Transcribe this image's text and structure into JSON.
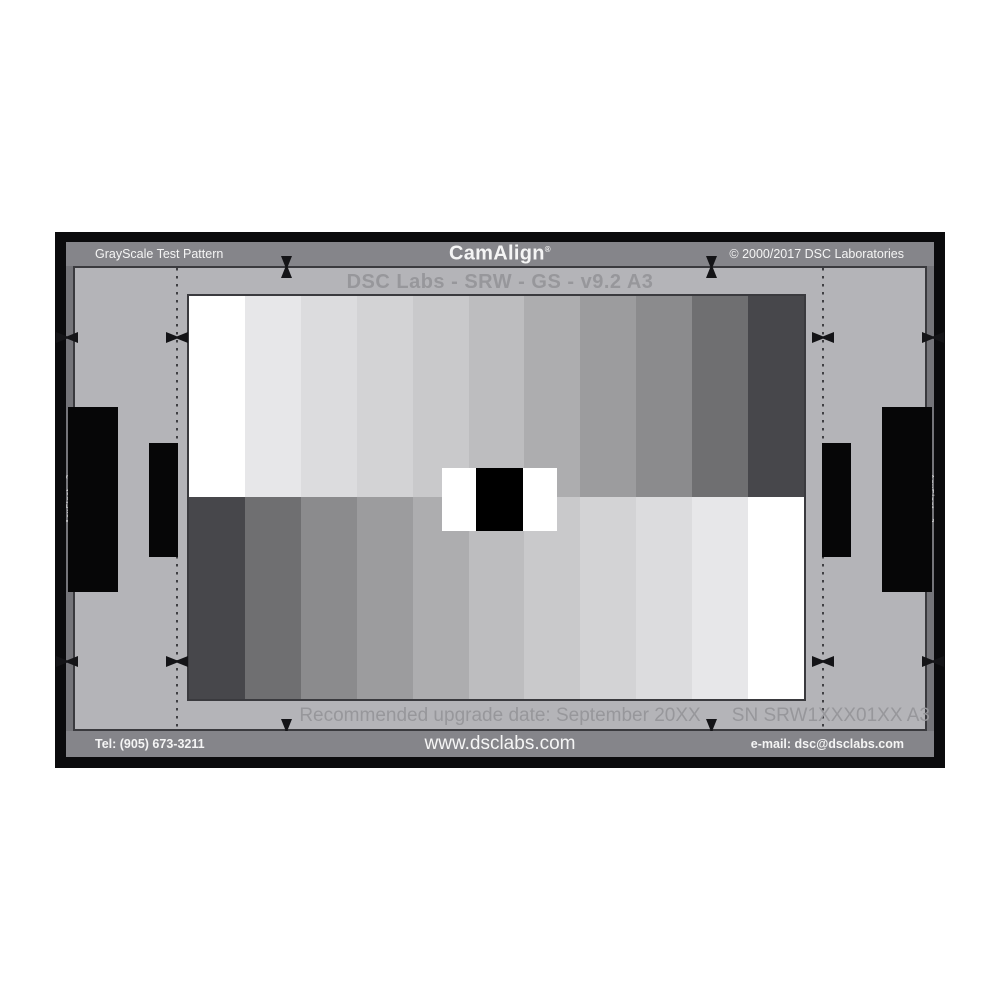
{
  "chart": {
    "header": {
      "product_line": "GrayScale Test Pattern",
      "brand": "CamAlign",
      "registered_mark": "®",
      "copyright": "© 2000/2017 DSC Laboratories"
    },
    "subtitle": "DSC Labs - SRW - GS - v9.2 A3",
    "side_label": "AcuFlect - 3",
    "upgrade_note": "Recommended upgrade date: September 20XX",
    "serial_number": "SN SRW1XXX01XX A3",
    "footer": {
      "telephone": "Tel: (905) 673-3211",
      "website": "www.dsclabs.com",
      "email": "e-mail: dsc@dsclabs.com"
    },
    "colors": {
      "frame": "#0b0b0d",
      "band_gray": "#85858a",
      "field_gray": "#b4b4b8",
      "side_strip_gray": "#75757a",
      "line_dark": "#3a3a3e",
      "muted_text": "#97979b",
      "patch_black": "#000000",
      "patch_white": "#ffffff"
    },
    "chart_data": {
      "type": "grayscale-step-pattern",
      "rows": 2,
      "steps_per_row": 11,
      "top_row_order": "white to dark, left to right",
      "bottom_row_order": "dark to white, left to right",
      "step_colors": [
        "#ffffff",
        "#e7e7e9",
        "#dcdcde",
        "#d3d3d5",
        "#c9c9cb",
        "#bdbdbf",
        "#adadaf",
        "#9c9c9e",
        "#8b8b8d",
        "#6f6f71",
        "#47474b"
      ],
      "center_patch": {
        "left_flank": "#ffffff",
        "center": "#000000",
        "right_flank": "#ffffff"
      }
    }
  }
}
